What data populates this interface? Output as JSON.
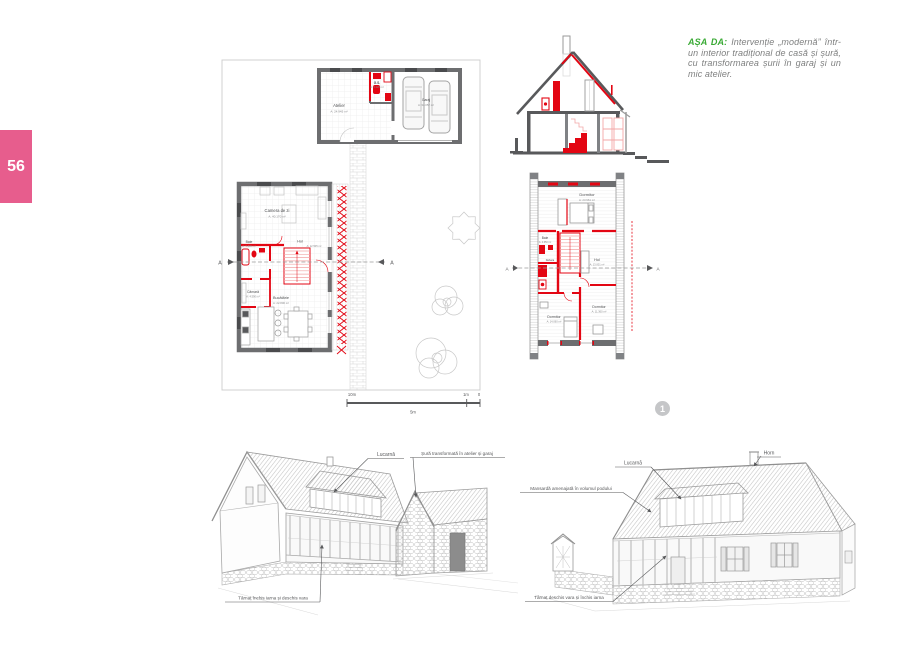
{
  "page": {
    "number": "56"
  },
  "caption": {
    "heading": "AȘA DA:",
    "body": "Intervenție „modernă” într-un interior tradițional de casă și șură, cu transformarea șurii în garaj și un mic atelier."
  },
  "figure": {
    "number": "1"
  },
  "colors": {
    "accent_pink": "#e75d8d",
    "accent_green": "#3aaa35",
    "intervention_red": "#e30613",
    "wall_gray": "#6d6e70"
  },
  "annex_plan": {
    "rooms": [
      {
        "name": "Atelier",
        "area": "A: 24.945 m²"
      },
      {
        "name": "G.S.",
        "area": "A: 5.220 m²"
      },
      {
        "name": "Garaj",
        "area": "A: 34.057 m²"
      }
    ]
  },
  "ground_floor_plan": {
    "section_mark": "A",
    "rooms": [
      {
        "name": "Camera de zi",
        "area": "A: 40.170 m²"
      },
      {
        "name": "Baie",
        "area": "A: 5.800 m²"
      },
      {
        "name": "Hol",
        "area": "A: 12.505 m²"
      },
      {
        "name": "Cămară",
        "area": "A: 4.590 m²"
      },
      {
        "name": "Bucătărie",
        "area": "A: 22.800 m²"
      }
    ]
  },
  "upper_floor_plan": {
    "section_mark": "A",
    "rooms": [
      {
        "name": "Dormitor",
        "area": "A: 23.961 m²"
      },
      {
        "name": "Baie",
        "area": "A: 4.650 m²"
      },
      {
        "name": "Debara",
        "area": ""
      },
      {
        "name": "Hol",
        "area": "A: 13.001 m²"
      },
      {
        "name": "Dormitor",
        "area": "A: 11.360 m²"
      },
      {
        "name": "Dormitor",
        "area": "A: 14.060 m²"
      }
    ]
  },
  "scale_bar": {
    "ten": "10m",
    "five": "5m",
    "one": "1m",
    "zero": "0"
  },
  "sketch_left": {
    "labels": {
      "dormer": "Lucarnă",
      "barn": "Șură transformată în atelier și garaj",
      "porch": "Târnaț închis iarna și deschis vara"
    }
  },
  "sketch_right": {
    "labels": {
      "dormer": "Lucarnă",
      "chimney": "Horn",
      "attic": "Mansardă amenajată în volumul podului",
      "porch": "Târnaț deschis vara și închis iarna"
    }
  }
}
